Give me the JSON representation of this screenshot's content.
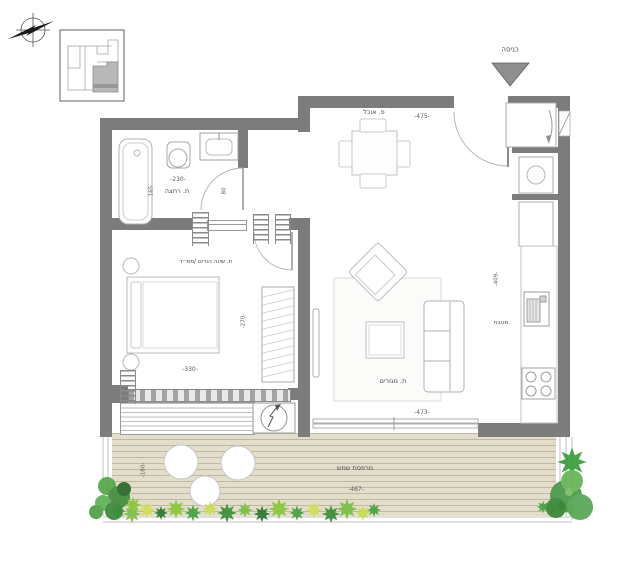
{
  "plan": {
    "entrance_label": "כניסה",
    "rooms": {
      "dining": {
        "label": "פ. אוכל",
        "width": "-475-"
      },
      "bathroom": {
        "label": "ת. רחצה",
        "width": "-230-",
        "depth": "165",
        "door_width": "80"
      },
      "bedroom": {
        "label": "ת. שינה הורים /ממ״ד",
        "width": "-330-",
        "depth": "-270-"
      },
      "living": {
        "label": "ת. מגורים",
        "width": "-473-",
        "depth": "-409-"
      },
      "kitchen": {
        "label": "מטבח"
      },
      "balcony": {
        "label": "מרפסת שמש",
        "width": "-467-",
        "depth": "-180-"
      }
    },
    "colors": {
      "wall": "#7c7c7c",
      "deck": "#e3decb",
      "plant_green": "#4c9b4c",
      "plant_light": "#8cc63f",
      "plant_yellow": "#cfe05a",
      "key_plan_unit": "#b8b8b8"
    }
  }
}
